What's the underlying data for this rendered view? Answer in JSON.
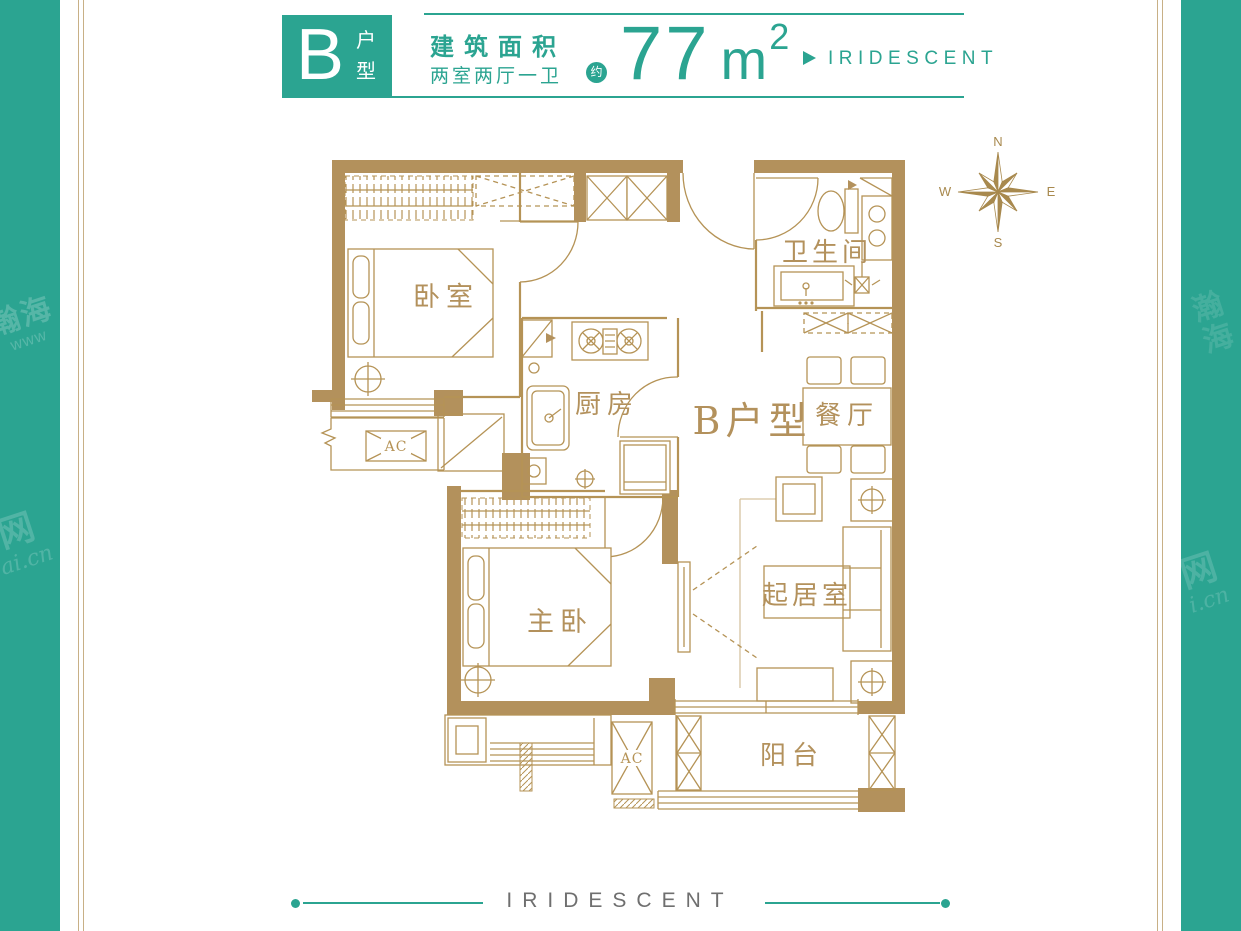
{
  "header": {
    "unit_letter": "B",
    "unit_suffix_top": "户",
    "unit_suffix_bottom": "型",
    "area_title": "建筑面积",
    "rooms_desc": "两室两厅一卫",
    "approx": "约",
    "area_value": "77",
    "area_unit": "m",
    "area_sup": "2",
    "brand": "IRIDESCENT"
  },
  "compass": {
    "n": "N",
    "e": "E",
    "s": "S",
    "w": "W"
  },
  "plan": {
    "unit_label": "B户型",
    "rooms": {
      "bedroom": "卧室",
      "kitchen": "厨房",
      "bathroom": "卫生间",
      "dining": "餐厅",
      "master_bedroom": "主卧",
      "living_room": "起居室",
      "balcony": "阳台"
    },
    "ac_label_left": "AC",
    "ac_label_balcony": "AC"
  },
  "footer": {
    "brand": "IRIDESCENT"
  },
  "watermarks": {
    "left_top": "瀚海",
    "left_top_sub": "www",
    "left_bottom": "网",
    "left_bottom_sub": "ai.cn",
    "right_top": "瀚海",
    "right_bottom": "网",
    "right_bottom_sub": "i.cn"
  },
  "colors": {
    "teal": "#2ba491",
    "gold": "#b3915c",
    "gold-line": "#b59356",
    "gold-dark": "#a8894e",
    "gray": "#6f6f6f"
  }
}
